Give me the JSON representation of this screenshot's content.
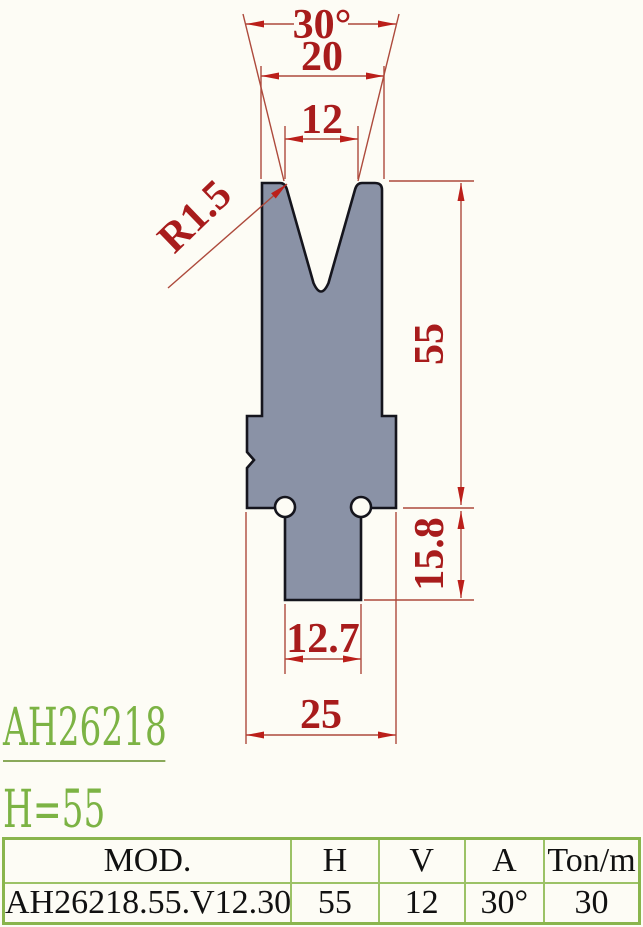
{
  "title_block": {
    "model": "AH26218",
    "height_label": "H=55"
  },
  "dimensions": {
    "angle": "30°",
    "top_width": "20",
    "v_opening": "12",
    "tip_radius": "R1.5",
    "body_height": "55",
    "shoulder_height": "15.8",
    "tang_width": "12.7",
    "base_width": "25"
  },
  "table": {
    "headers": [
      "MOD.",
      "H",
      "V",
      "A",
      "Ton/m"
    ],
    "rows": [
      [
        "AH26218.55.V12.30",
        "55",
        "12",
        "30°",
        "30"
      ]
    ]
  },
  "colors": {
    "die_fill": "#8a92a6",
    "outline_black": "#15151d",
    "dimension_text_red": "#a81c1c",
    "dimension_line_red": "#ad4a3c",
    "accent_green": "#7cb344",
    "table_border_green": "#8ab54d",
    "background": "#fdfcf5"
  }
}
